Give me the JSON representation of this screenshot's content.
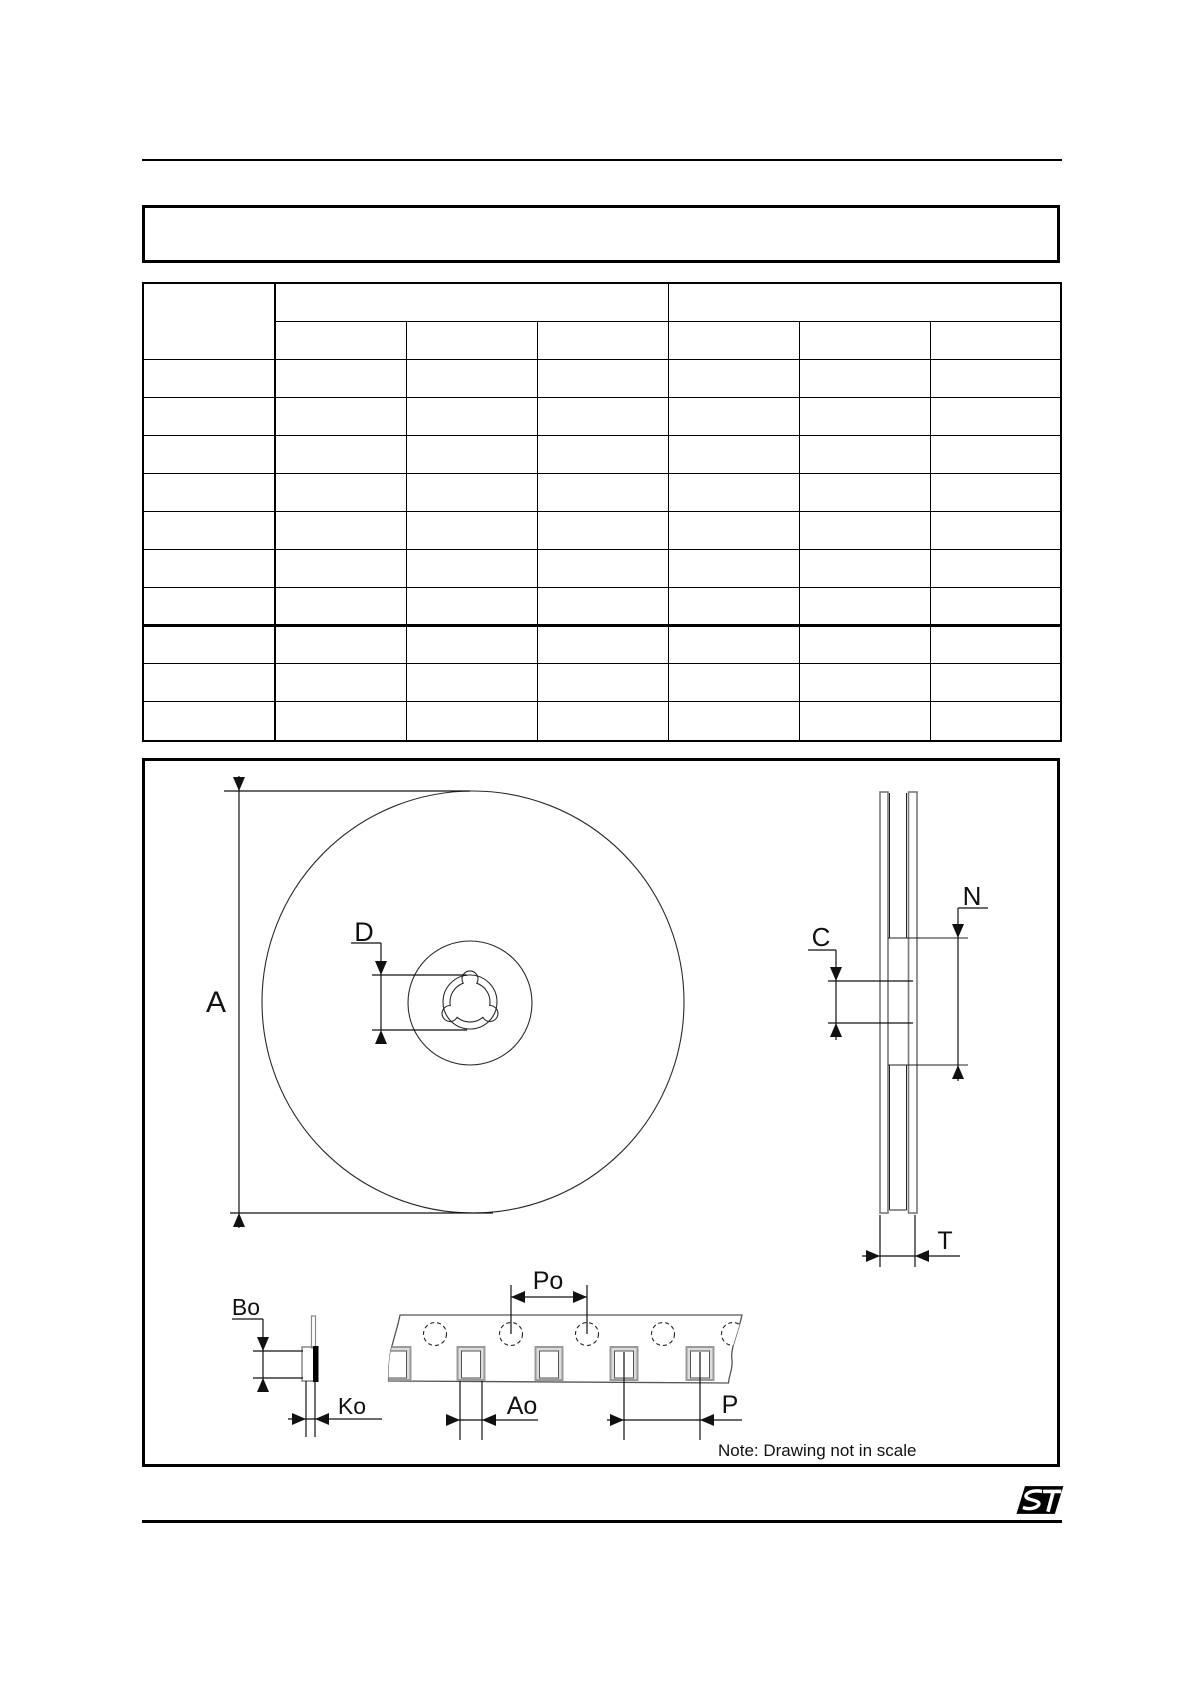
{
  "figure": {
    "labels": {
      "A": "A",
      "D": "D",
      "C": "C",
      "N": "N",
      "T": "T",
      "Po": "Po",
      "Bo": "Bo",
      "Ko": "Ko",
      "Ao": "Ao",
      "P": "P"
    },
    "note": "Note: Drawing not in scale"
  },
  "icons": {
    "footer_logo": "st-logo"
  },
  "colors": {
    "line_black": "#000000",
    "drawing_gray": "#8a8a8a",
    "pocket_fill": "#dcdcdc"
  }
}
